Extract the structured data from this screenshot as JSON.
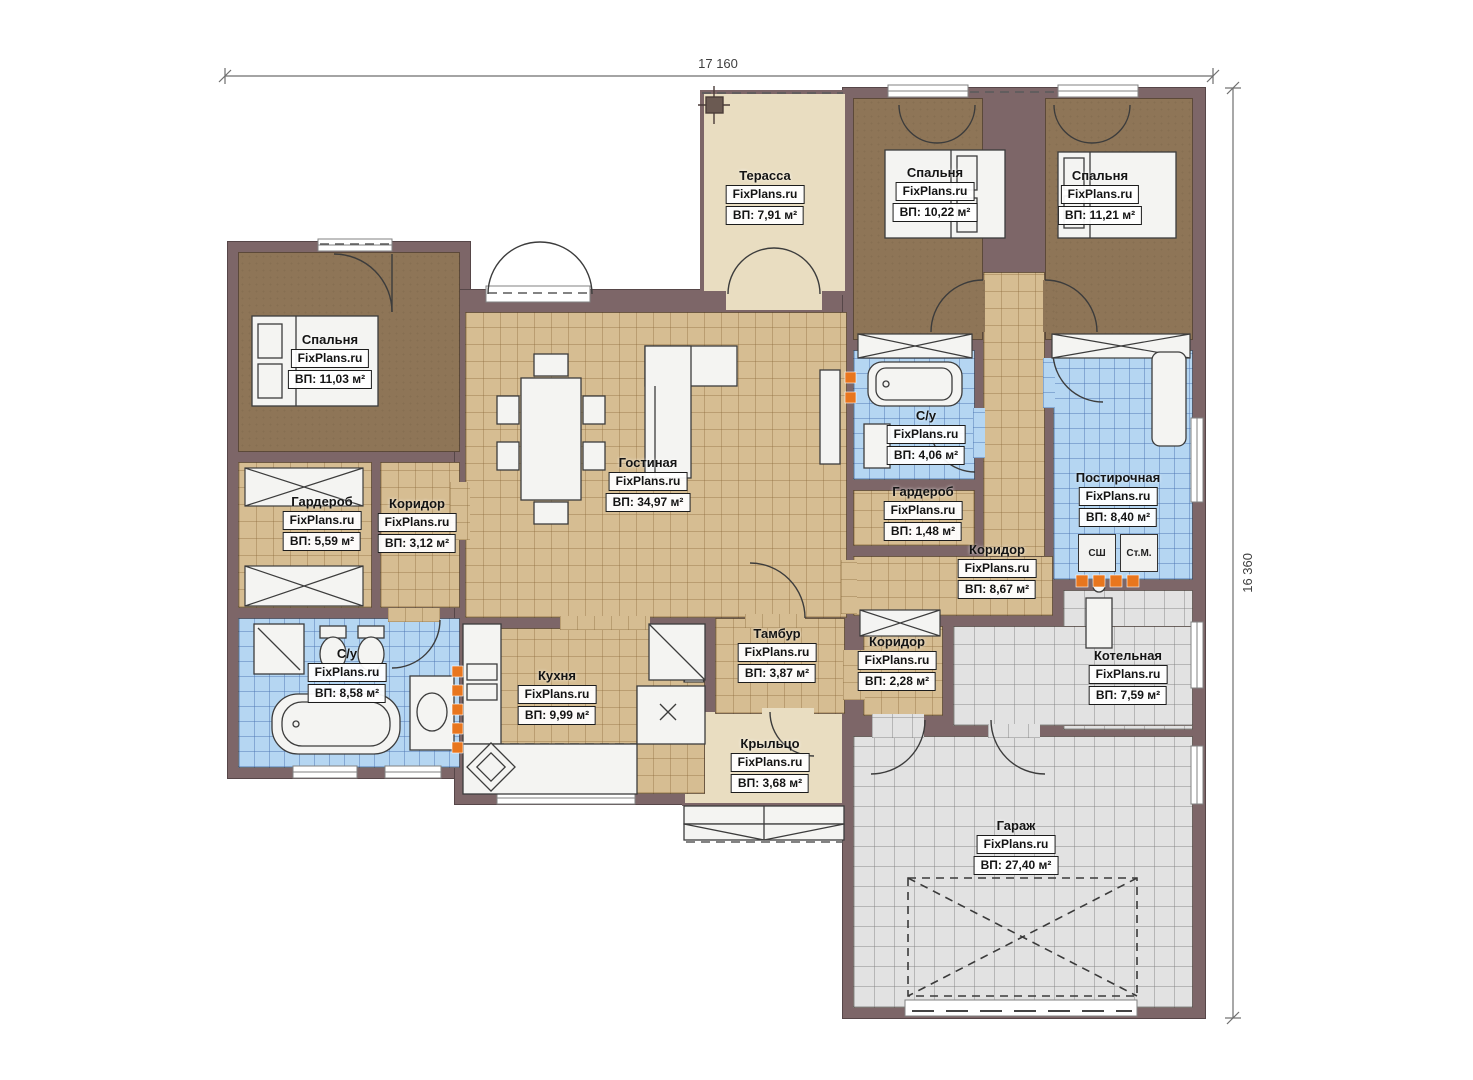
{
  "brand": "FixPlans.ru",
  "dimensions": {
    "width": "17 160",
    "height": "16 360"
  },
  "appliances": {
    "dryer": "СШ",
    "washer": "Ст.М."
  },
  "rooms": [
    {
      "name": "Терасса",
      "area": "ВП: 7,91 м²"
    },
    {
      "name": "Спальня",
      "area": "ВП: 10,22 м²"
    },
    {
      "name": "Спальня",
      "area": "ВП: 11,21 м²"
    },
    {
      "name": "Спальня",
      "area": "ВП: 11,03 м²"
    },
    {
      "name": "Гостиная",
      "area": "ВП: 34,97 м²"
    },
    {
      "name": "С/у",
      "area": "ВП: 4,06 м²"
    },
    {
      "name": "Гардероб",
      "area": "ВП: 5,59 м²"
    },
    {
      "name": "Коридор",
      "area": "ВП: 3,12 м²"
    },
    {
      "name": "Гардероб",
      "area": "ВП: 1,48 м²"
    },
    {
      "name": "Коридор",
      "area": "ВП: 8,67 м²"
    },
    {
      "name": "Постирочная",
      "area": "ВП: 8,40 м²"
    },
    {
      "name": "С/у",
      "area": "ВП: 8,58 м²"
    },
    {
      "name": "Кухня",
      "area": "ВП: 9,99 м²"
    },
    {
      "name": "Тамбур",
      "area": "ВП: 3,87 м²"
    },
    {
      "name": "Коридор",
      "area": "ВП: 2,28 м²"
    },
    {
      "name": "Котельная",
      "area": "ВП: 7,59 м²"
    },
    {
      "name": "Крыльцо",
      "area": "ВП: 3,68 м²"
    },
    {
      "name": "Гараж",
      "area": "ВП: 27,40 м²"
    }
  ],
  "colors": {
    "wall": "#7d6668",
    "floor_tile": "#d6bd92",
    "floor_bedroom": "#8e7557",
    "floor_wet": "#b5d6f2",
    "floor_garage": "#e2e2e2",
    "floor_terrace": "#e9ddc1",
    "vent_orange": "#e8761e"
  }
}
